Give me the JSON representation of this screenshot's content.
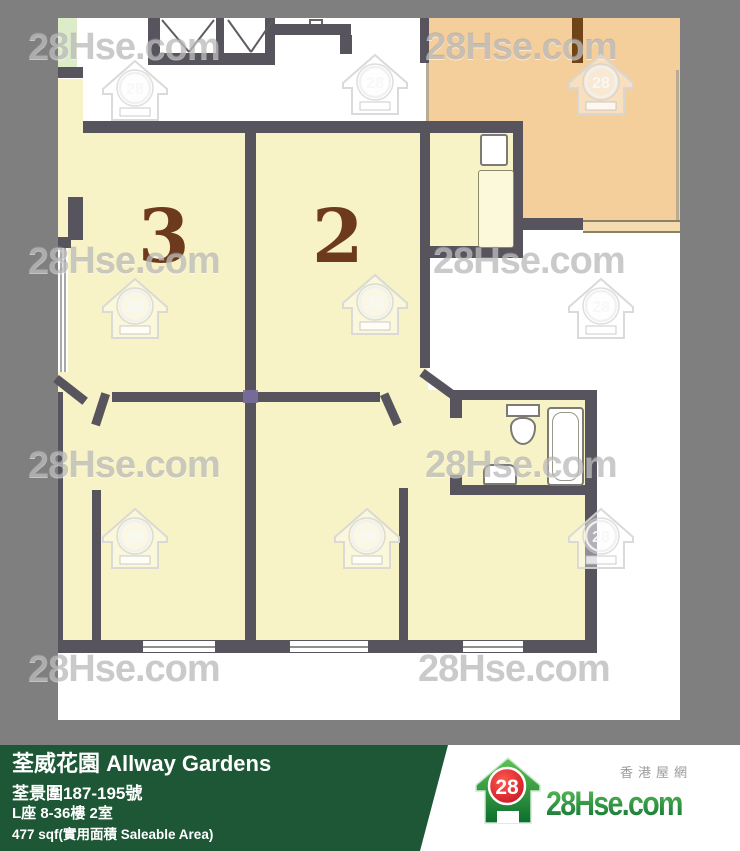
{
  "watermark": {
    "text": "28Hse.com",
    "badge": "28",
    "text_positions": [
      {
        "x": 28,
        "y": 26
      },
      {
        "x": 425,
        "y": 26
      },
      {
        "x": 28,
        "y": 240
      },
      {
        "x": 433,
        "y": 240
      },
      {
        "x": 28,
        "y": 444
      },
      {
        "x": 425,
        "y": 444
      },
      {
        "x": 28,
        "y": 648
      },
      {
        "x": 418,
        "y": 648
      }
    ],
    "house_positions": [
      {
        "x": 100,
        "y": 58
      },
      {
        "x": 340,
        "y": 52
      },
      {
        "x": 566,
        "y": 52
      },
      {
        "x": 100,
        "y": 276
      },
      {
        "x": 340,
        "y": 272
      },
      {
        "x": 566,
        "y": 276
      },
      {
        "x": 100,
        "y": 506
      },
      {
        "x": 332,
        "y": 506
      },
      {
        "x": 566,
        "y": 506
      }
    ]
  },
  "floorplan": {
    "room3_label": "3",
    "room2_label": "2"
  },
  "banner": {
    "title": "荃威花園 Allway Gardens",
    "address": "荃景圍187-195號",
    "unit": "L座 8-36樓 2室",
    "area": "477 sqf(實用面積 Saleable Area)"
  },
  "logo": {
    "badge": "28",
    "brand": "28Hse.com",
    "tagline": "香港屋網"
  },
  "colors": {
    "background_gray": "#7f7f7f",
    "banner_green": "#1d5736",
    "wall_gray": "#57545e",
    "room_cream": "#f8f3c6",
    "neighbor_orange": "#f5cf9b",
    "green_strip": "#dcecc8",
    "badge_red": "#d6112b",
    "brand_green": "#0f7a34",
    "room_number_brown": "#6d3a1d"
  }
}
